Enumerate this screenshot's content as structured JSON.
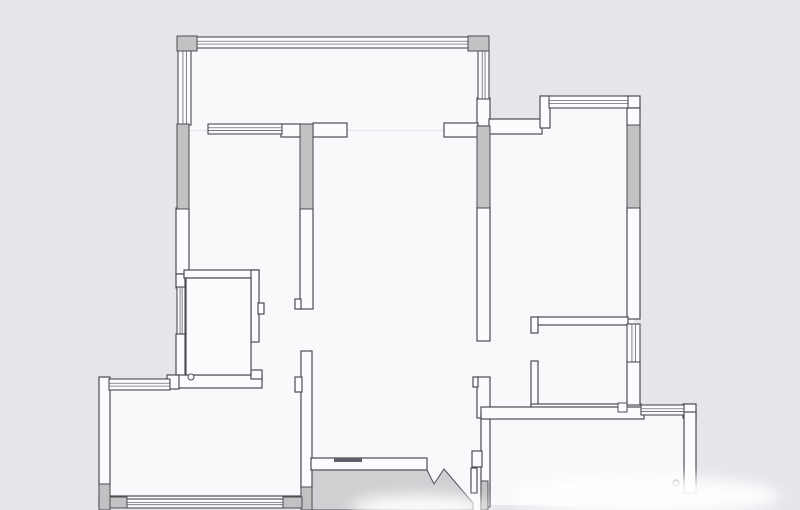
{
  "document": {
    "type": "floor-plan",
    "description": "Apartment floor plan line drawing, no text labels visible"
  },
  "palette": {
    "background": "#e4e6ea",
    "floor": "#f8f9fb",
    "wall": "#fbfcfd",
    "stroke": "#4c4c55",
    "gray": "#c4c1c3",
    "outside": "#d1cfd2",
    "threshold": "#60606a",
    "blur": "#ffffff"
  },
  "floorplan": {
    "floors": [
      {
        "name": "floor-balcony",
        "r": [
          182,
          42,
          303,
          88
        ]
      },
      {
        "name": "floor-bedroom-left-suite",
        "r": [
          182,
          131,
          126,
          262
        ]
      },
      {
        "name": "floor-living-room",
        "r": [
          307,
          131,
          177,
          335
        ]
      },
      {
        "name": "floor-entry",
        "r": [
          420,
          450,
          67,
          60
        ]
      },
      {
        "name": "floor-bedroom-right-west",
        "r": [
          484,
          126,
          58,
          286
        ]
      },
      {
        "name": "floor-bedroom-right-east",
        "r": [
          542,
          100,
          92,
          312
        ]
      },
      {
        "name": "floor-room-bottom-left",
        "r": [
          104,
          382,
          196,
          125
        ]
      },
      {
        "name": "floor-room-bottom-right",
        "r": [
          478,
          407,
          218,
          98
        ]
      }
    ],
    "outside": [
      {
        "name": "outside-lower-area",
        "points": "311,470 427,470 434,484 444,469 473,503 473,510 311,510"
      }
    ],
    "walls_white": [
      {
        "name": "wall-balcony-right-stub",
        "r": [
          477,
          98,
          13,
          28
        ]
      },
      {
        "name": "wall-pier-window-end",
        "r": [
          281,
          124,
          20,
          13
        ]
      },
      {
        "name": "wall-stub-living-left",
        "r": [
          313,
          123,
          34,
          14
        ]
      },
      {
        "name": "wall-stub-living-right",
        "r": [
          444,
          123,
          34,
          14
        ]
      },
      {
        "name": "wall-left-middle",
        "r": [
          176,
          208,
          13,
          66
        ]
      },
      {
        "name": "wall-bath-left-upper",
        "r": [
          176,
          274,
          9,
          14
        ]
      },
      {
        "name": "wall-bath-left-lower",
        "r": [
          176,
          334,
          9,
          42
        ]
      },
      {
        "name": "wall-bath-top",
        "r": [
          184,
          270,
          75,
          8
        ]
      },
      {
        "name": "wall-bath-right",
        "r": [
          251,
          270,
          8,
          72
        ]
      },
      {
        "name": "wall-bath-latch-bump",
        "r": [
          258,
          303,
          6,
          11
        ]
      },
      {
        "name": "wall-bath-bottom",
        "r": [
          176,
          375,
          86,
          13
        ]
      },
      {
        "name": "wall-bath-door-jamb",
        "r": [
          251,
          370,
          11,
          9
        ]
      },
      {
        "name": "wall-outer-left",
        "r": [
          99,
          377,
          11,
          108
        ]
      },
      {
        "name": "wall-corner-connector",
        "r": [
          167,
          375,
          12,
          14
        ]
      },
      {
        "name": "wall-middle-upper",
        "r": [
          300,
          208,
          13,
          101
        ]
      },
      {
        "name": "wall-middle-jamb-upper",
        "r": [
          295,
          299,
          6,
          10
        ]
      },
      {
        "name": "wall-middle-lower",
        "r": [
          301,
          351,
          11,
          137
        ]
      },
      {
        "name": "wall-middle-jamb-lower",
        "r": [
          295,
          377,
          7,
          15
        ]
      },
      {
        "name": "wall-dining-bottom",
        "r": [
          311,
          458,
          116,
          12
        ]
      },
      {
        "name": "wall-right-upper",
        "r": [
          477,
          207,
          13,
          134
        ]
      },
      {
        "name": "wall-right-door-jamb-seg",
        "r": [
          477,
          377,
          13,
          41
        ]
      },
      {
        "name": "wall-right-jamb-bump",
        "r": [
          473,
          377,
          5,
          10
        ]
      },
      {
        "name": "wall-bottomright-left",
        "r": [
          481,
          413,
          9,
          94
        ]
      },
      {
        "name": "wall-entry-jamb-a",
        "r": [
          472,
          451,
          10,
          16
        ]
      },
      {
        "name": "wall-entry-jamb-b",
        "r": [
          471,
          468,
          6,
          25
        ]
      },
      {
        "name": "wall-step-top-right",
        "r": [
          489,
          119,
          53,
          15
        ]
      },
      {
        "name": "wall-step-cap-vertical",
        "r": [
          540,
          96,
          10,
          32
        ]
      },
      {
        "name": "wall-window-cap-topright",
        "r": [
          627,
          96,
          13,
          12
        ]
      },
      {
        "name": "wall-topright-upper",
        "r": [
          627,
          108,
          13,
          18
        ]
      },
      {
        "name": "wall-topright-middle",
        "r": [
          627,
          207,
          13,
          112
        ]
      },
      {
        "name": "wall-smallroom-top",
        "r": [
          537,
          317,
          91,
          8
        ]
      },
      {
        "name": "wall-smallroom-door-jamb",
        "r": [
          531,
          317,
          7,
          16
        ]
      },
      {
        "name": "wall-smallroom-left",
        "r": [
          531,
          361,
          7,
          49
        ]
      },
      {
        "name": "wall-smallroom-bottom",
        "r": [
          531,
          404,
          110,
          9
        ]
      },
      {
        "name": "wall-smallroom-right-lower",
        "r": [
          627,
          361,
          13,
          44
        ]
      },
      {
        "name": "wall-bottomright-top",
        "r": [
          481,
          407,
          163,
          12
        ]
      },
      {
        "name": "wall-bottomright-window-cap",
        "r": [
          683,
          404,
          13,
          14
        ]
      },
      {
        "name": "wall-bottomright-right",
        "r": [
          684,
          412,
          12,
          81
        ]
      },
      {
        "name": "wall-bottomleft-bottom",
        "r": [
          99,
          496,
          203,
          11
        ]
      },
      {
        "name": "wall-bath-inner-outline",
        "r": [
          186,
          278,
          65,
          97
        ]
      }
    ],
    "windows": [
      {
        "name": "window-balcony-top",
        "r": [
          196,
          37,
          273,
          11
        ],
        "o": "h"
      },
      {
        "name": "window-balcony-left",
        "r": [
          178,
          50,
          13,
          75
        ],
        "o": "v"
      },
      {
        "name": "window-balcony-right",
        "r": [
          478,
          50,
          11,
          49
        ],
        "o": "v"
      },
      {
        "name": "window-bedroom-left-north",
        "r": [
          208,
          124,
          74,
          10
        ],
        "o": "h"
      },
      {
        "name": "window-bathroom",
        "r": [
          177,
          287,
          8,
          47
        ],
        "o": "v"
      },
      {
        "name": "window-bottomleft-top",
        "r": [
          109,
          379,
          61,
          11
        ],
        "o": "h"
      },
      {
        "name": "window-bedroom-right-north",
        "r": [
          549,
          96,
          79,
          12
        ],
        "o": "h"
      },
      {
        "name": "window-smallroom-east",
        "r": [
          627,
          324,
          13,
          38
        ],
        "o": "v"
      },
      {
        "name": "window-bottomright-east",
        "r": [
          641,
          405,
          43,
          10
        ],
        "o": "h"
      },
      {
        "name": "window-bottomleft-south",
        "r": [
          126,
          499,
          158,
          9
        ],
        "o": "h"
      }
    ],
    "walls_gray": [
      {
        "name": "column-top-left",
        "r": [
          177,
          36,
          20,
          15
        ]
      },
      {
        "name": "column-top-right",
        "r": [
          468,
          36,
          21,
          15
        ]
      },
      {
        "name": "pier-left-wall",
        "r": [
          177,
          124,
          12,
          85
        ]
      },
      {
        "name": "pier-middle-wall",
        "r": [
          300,
          124,
          13,
          85
        ]
      },
      {
        "name": "pier-right-wall",
        "r": [
          477,
          126,
          13,
          82
        ]
      },
      {
        "name": "pier-topright-wall",
        "r": [
          627,
          125,
          13,
          83
        ]
      },
      {
        "name": "pier-outer-left-bottom",
        "r": [
          99,
          484,
          11,
          26
        ]
      },
      {
        "name": "pier-bottomleft-right",
        "r": [
          301,
          487,
          11,
          23
        ]
      },
      {
        "name": "pier-bottomleft-sw",
        "r": [
          110,
          497,
          17,
          11
        ]
      },
      {
        "name": "pier-bottomleft-se",
        "r": [
          283,
          497,
          19,
          11
        ]
      },
      {
        "name": "pier-entry-strip",
        "r": [
          481,
          481,
          7,
          29
        ]
      }
    ],
    "fixtures_squares": [
      {
        "name": "fixture-box-smallroom",
        "r": [
          618,
          403,
          9,
          9
        ]
      }
    ],
    "fixtures_circles": [
      {
        "name": "drain-bathroom",
        "c": [
          191,
          377,
          3
        ]
      },
      {
        "name": "drain-bottomright-room",
        "c": [
          676,
          483,
          3
        ]
      }
    ],
    "marks": [
      {
        "name": "door-threshold",
        "r": [
          334,
          458,
          28,
          4
        ]
      }
    ],
    "blurs": [
      {
        "name": "watermark-blur-main",
        "e": [
          645,
          496,
          135,
          20
        ]
      },
      {
        "name": "watermark-blur-left",
        "e": [
          420,
          507,
          70,
          12
        ]
      }
    ]
  }
}
